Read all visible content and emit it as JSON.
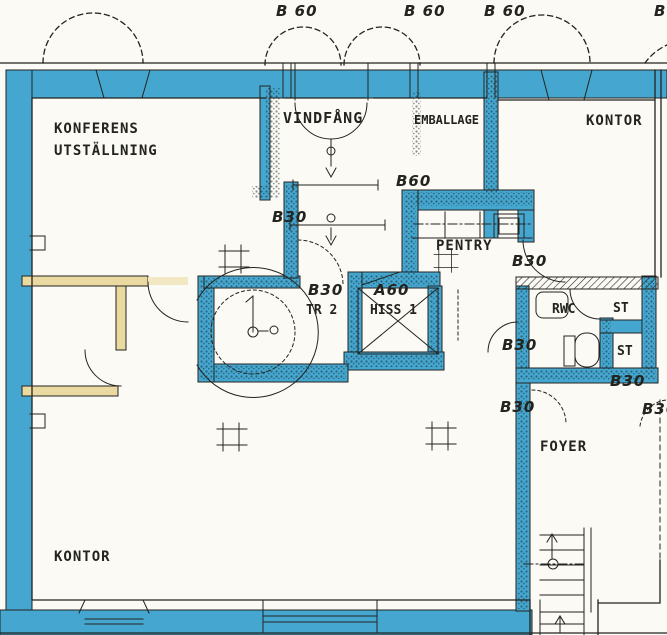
{
  "plan": {
    "type": "architectural-floor-plan",
    "colors": {
      "highlight_wall_blue": "#45a7d0",
      "partition_wall_yellow": "#ead9a0",
      "ink": "#23231f",
      "paper": "#fbfaf4"
    },
    "rooms": {
      "konferens_line1": "KONFERENS",
      "konferens_line2": "UTSTÄLLNING",
      "vindfang": "VINDFÅNG",
      "emballage": "EMBALLAGE",
      "kontor_ne": "KONTOR",
      "pentry": "PENTRY",
      "rwc": "RWC",
      "st_upper": "ST",
      "st_lower": "ST",
      "tr2": "TR 2",
      "hiss": "HISS 1",
      "foyer": "FOYER",
      "kontor_sw": "KONTOR"
    },
    "doors": {
      "top_1": "B 60",
      "top_2": "B 60",
      "top_3": "B 60",
      "top_right_partial": "B",
      "pentry": "B60",
      "tr2_upper": "B30",
      "tr2": "B30",
      "hiss": "A60",
      "kontor": "B30",
      "rwc": "B30",
      "st": "B30",
      "foyer_left": "B30",
      "foyer_right": "B30"
    }
  }
}
